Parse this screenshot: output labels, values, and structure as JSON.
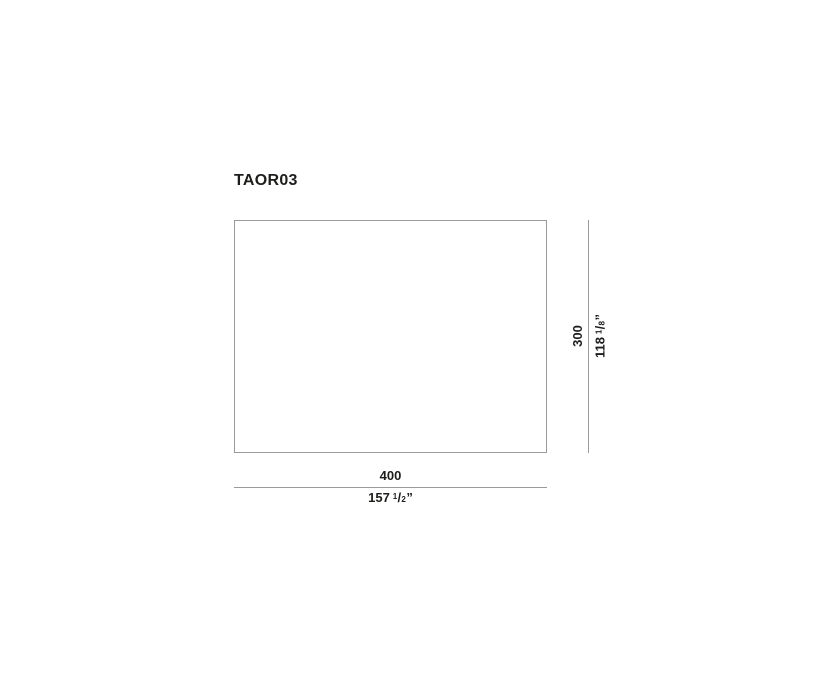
{
  "product": {
    "code": "TAOR03"
  },
  "colors": {
    "background": "#ffffff",
    "line": "#9a9a9a",
    "text": "#1d1d1b"
  },
  "dimensions": {
    "width": {
      "metric": "400",
      "imperial": {
        "whole": "157",
        "numerator": "1",
        "slash": "/",
        "denominator": "2",
        "unit": "”"
      }
    },
    "height": {
      "metric": "300",
      "imperial": {
        "whole": "118",
        "numerator": "1",
        "slash": "/",
        "denominator": "8",
        "unit": "”"
      }
    }
  }
}
